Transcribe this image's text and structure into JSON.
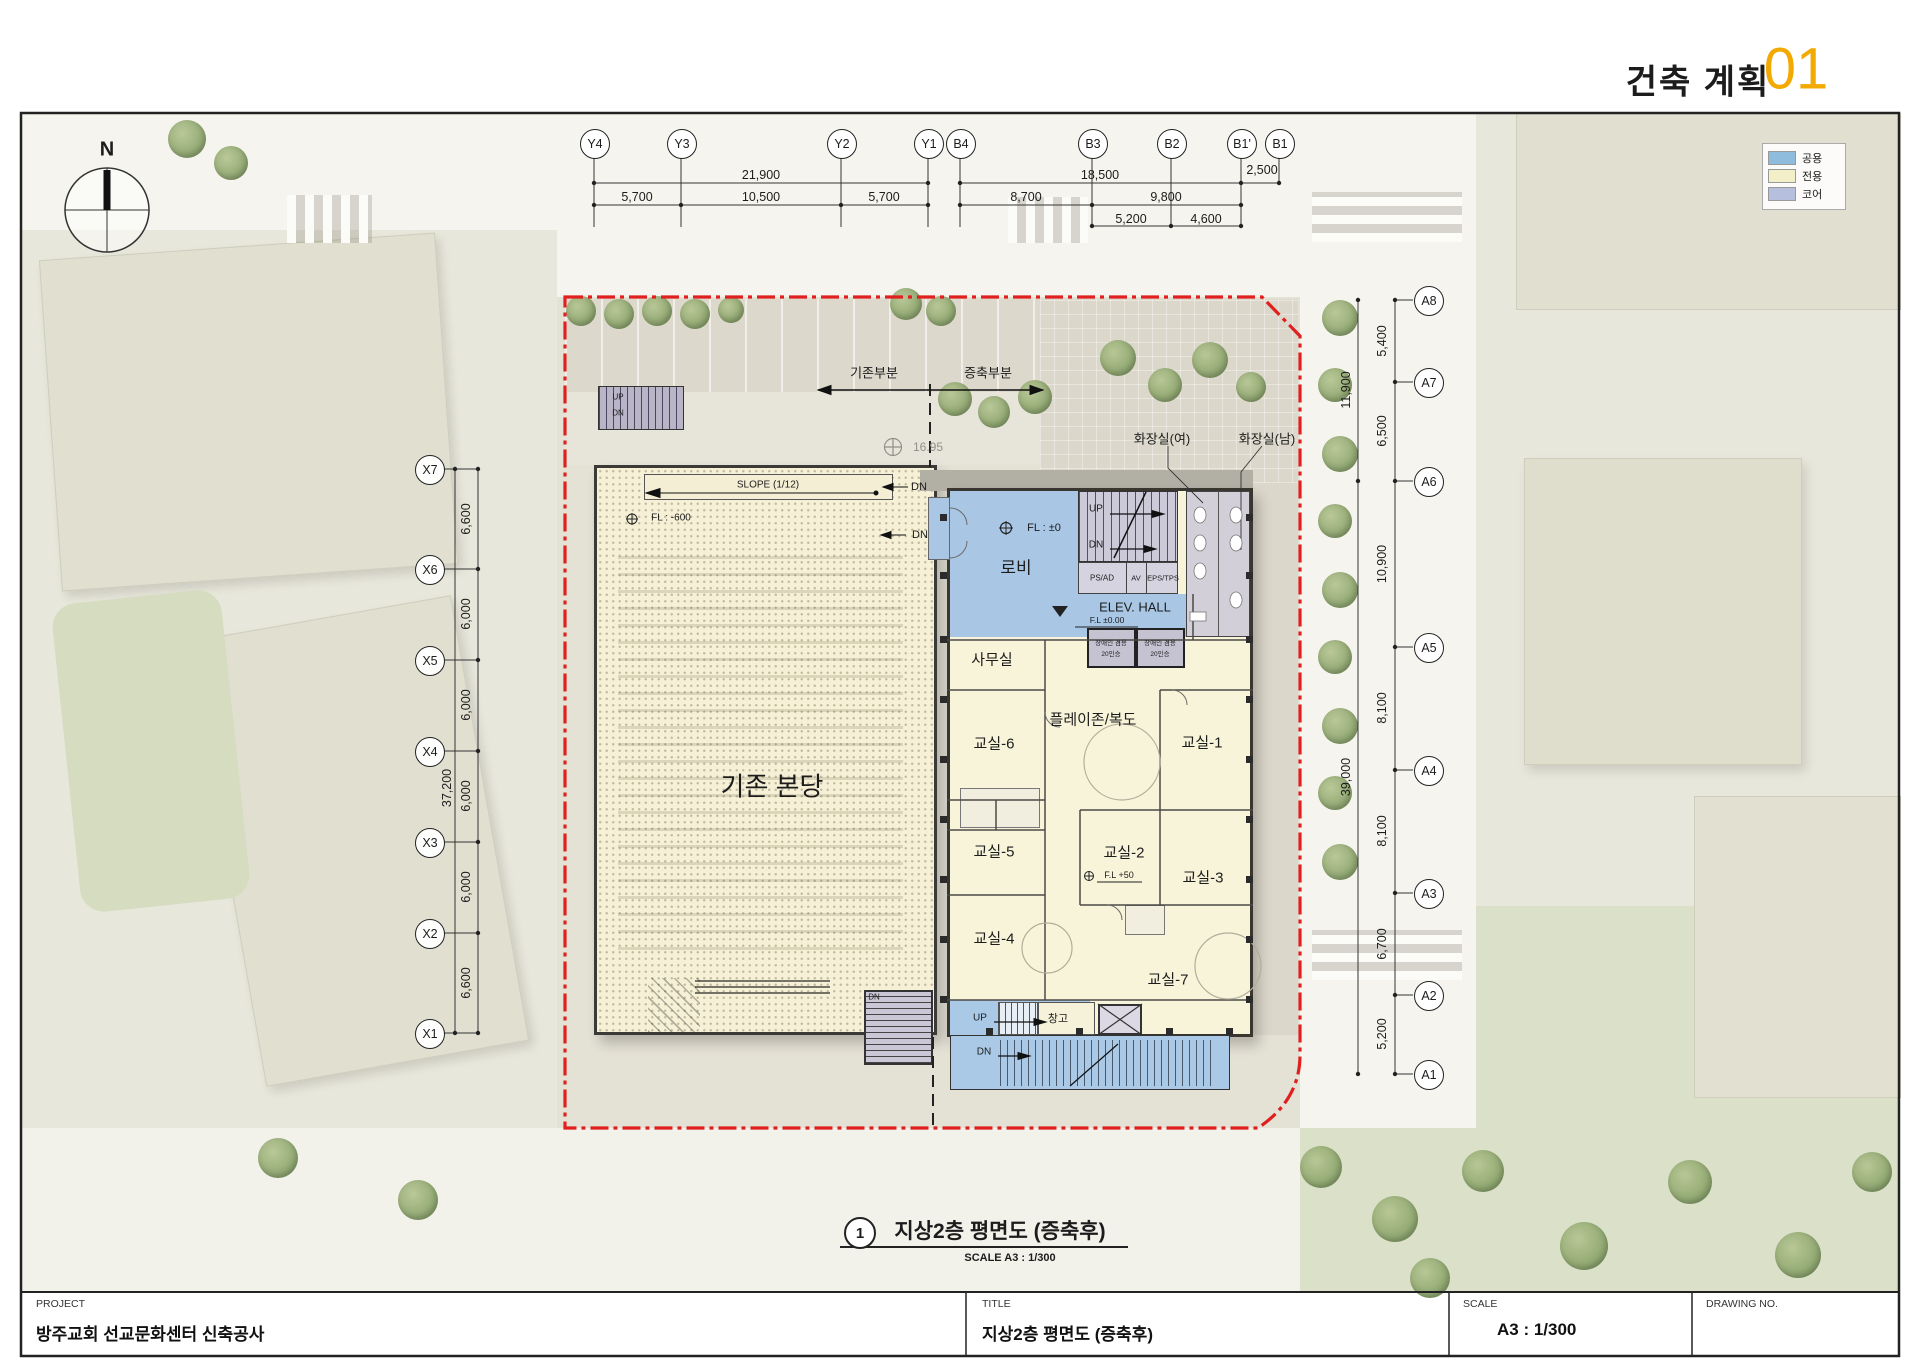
{
  "header": {
    "section_title": "건축 계획",
    "page_number": "01",
    "accent_color": "#F2A900"
  },
  "legend": {
    "items": [
      {
        "label": "공용"
      },
      {
        "label": "전용"
      },
      {
        "label": "코어"
      }
    ],
    "colors": {
      "public": "#8FBBDC",
      "private": "#F2EFC9",
      "core": "#B7BFDE"
    }
  },
  "compass": {
    "north_label": "N"
  },
  "grid": {
    "top": [
      "Y4",
      "Y3",
      "Y2",
      "Y1",
      "B4",
      "B3",
      "B2",
      "B1'",
      "B1"
    ],
    "left": [
      "X7",
      "X6",
      "X5",
      "X4",
      "X3",
      "X2",
      "X1"
    ],
    "right": [
      "A8",
      "A7",
      "A6",
      "A5",
      "A4",
      "A3",
      "A2",
      "A1"
    ]
  },
  "dims": {
    "top": {
      "row1": [
        "21,900",
        "18,500",
        "2,500"
      ],
      "row2": [
        "5,700",
        "10,500",
        "5,700",
        "8,700",
        "9,800"
      ],
      "row3": [
        "5,200",
        "4,600"
      ]
    },
    "left": {
      "segments": [
        "6,600",
        "6,000",
        "6,000",
        "6,000",
        "6,000",
        "6,600"
      ],
      "total": "37,200"
    },
    "right": {
      "segments": [
        "5,400",
        "6,500",
        "10,900",
        "8,100",
        "8,100",
        "6,700",
        "5,200"
      ],
      "upper_total": "11,900",
      "lower_total": "39,000"
    }
  },
  "plan": {
    "parts": {
      "existing": "기존부분",
      "extension": "증축부분"
    },
    "rooms": {
      "sanctuary": "기존 본당",
      "lobby": "로비",
      "elev_hall": "ELEV. HALL",
      "office": "사무실",
      "playzone": "플레이존/복도",
      "class1": "교실-1",
      "class2": "교실-2",
      "class3": "교실-3",
      "class4": "교실-4",
      "class5": "교실-5",
      "class6": "교실-6",
      "class7": "교실-7",
      "storage": "창고",
      "toilet_women": "화장실(여)",
      "toilet_men": "화장실(남)",
      "ps_ad": "PS/AD",
      "av": "AV",
      "eps_tps": "EPS/TPS"
    },
    "elevator": {
      "line1": "장애인 겸용",
      "line2": "20인승"
    },
    "notes": {
      "slope": "SLOPE (1/12)",
      "up": "UP",
      "dn": "DN",
      "fl_zero": "FL : ±0",
      "fl_zero_hall": "F.L ±0.00",
      "fl_plus50": "F.L +50",
      "fl_existing": "FL : -600",
      "spot_level": "16.95"
    }
  },
  "drawing_label": {
    "number": "1",
    "title": "지상2층 평면도 (증축후)",
    "scale": "SCALE A3 : 1/300"
  },
  "title_block": {
    "project_label": "PROJECT",
    "project_value": "방주교회 선교문화센터 신축공사",
    "title_label": "TITLE",
    "title_value": "지상2층 평면도 (증축후)",
    "scale_label": "SCALE",
    "scale_value": "A3 : 1/300",
    "drawing_no_label": "DRAWING NO."
  }
}
